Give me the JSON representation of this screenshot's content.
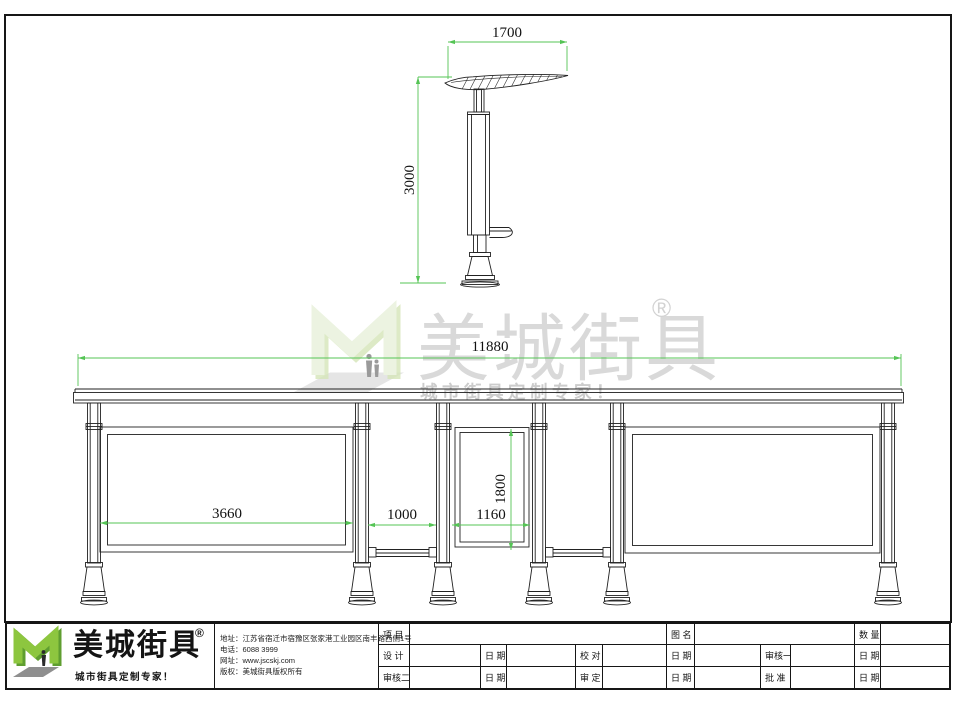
{
  "side_view": {
    "width_dim": "1700",
    "height_dim": "3000"
  },
  "elevation": {
    "total_width_dim": "11880",
    "left_panel_dim": "3660",
    "gap_dim": "1000",
    "lightbox_width_dim": "1160",
    "lightbox_height_dim": "1800"
  },
  "watermark": {
    "brand": "美城街具",
    "registered": "®",
    "tagline": "城市街具定制专家！"
  },
  "title_block": {
    "brand": "美城街具",
    "registered": "®",
    "tagline": "城市街具定制专家！",
    "contact": {
      "address": "地址：江苏省宿迁市宿豫区张家港工业园区南丰路西侧1号",
      "phone": "电话：6088 3999",
      "website": "网址：www.jscskj.com",
      "copyright": "版权：美城街具版权所有"
    },
    "table": {
      "r1": [
        "项 目",
        "",
        "图 名",
        "",
        "数 量",
        ""
      ],
      "r2": [
        "设 计",
        "",
        "日 期",
        "",
        "校 对",
        "",
        "日 期",
        "",
        "审核一",
        "",
        "日 期",
        ""
      ],
      "r3": [
        "审核二",
        "",
        "日 期",
        "",
        "审 定",
        "",
        "日 期",
        "",
        "批 准",
        "",
        "日 期",
        ""
      ]
    }
  },
  "colors": {
    "dimension_green": "#55c455",
    "line_black": "#222222",
    "logo_green": "#8dc63f"
  }
}
